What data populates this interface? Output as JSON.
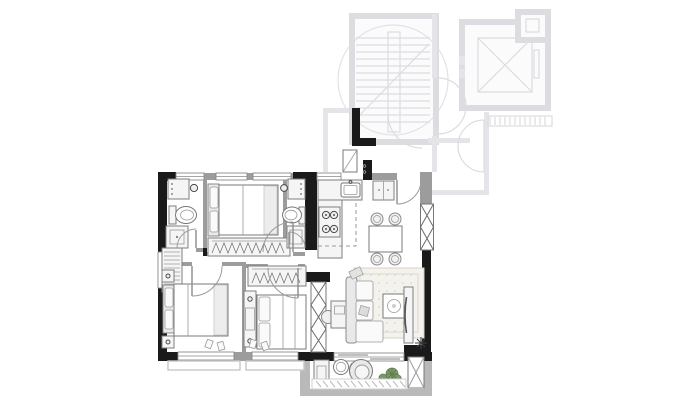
{
  "canvas": {
    "width": 694,
    "height": 411
  },
  "colors": {
    "background": "#ffffff",
    "wall_solid": "#1a1a1a",
    "wall_window": "#9c9c9c",
    "wall_light": "#b9b9b9",
    "fixture_stroke": "#7e7e7e",
    "fixture_dark": "#4a4a4a",
    "faded_common": "#dcdce1",
    "sill": "#c8c8c8",
    "rug_fill": "#f4f2ed",
    "rug_border": "#d8d3c9",
    "plant_green": "#7d9b68",
    "plant_dark": "#5e7c4e"
  },
  "plan": {
    "unit_rooms": [
      {
        "id": "bathroom-top-left",
        "fixtures": [
          "vanity-sink",
          "toilet",
          "shower"
        ]
      },
      {
        "id": "bedroom-top",
        "fixtures": [
          "double-bed",
          "wardrobe-with-hangers"
        ]
      },
      {
        "id": "bathroom-top-right",
        "fixtures": [
          "vanity-sink",
          "toilet",
          "shower"
        ]
      },
      {
        "id": "hallway",
        "fixtures": [
          "tall-shelf-cabinet"
        ]
      },
      {
        "id": "kitchen",
        "fixtures": [
          "l-counter",
          "cooktop-4-burner",
          "sink",
          "refrigerator"
        ]
      },
      {
        "id": "entry-nook",
        "fixtures": [
          "shoe-cabinet"
        ]
      },
      {
        "id": "dining",
        "fixtures": [
          "table",
          "chair",
          "chair",
          "chair",
          "chair"
        ]
      },
      {
        "id": "living",
        "fixtures": [
          "sofa",
          "rug",
          "coffee-table",
          "desk",
          "desk-chair",
          "tv-console",
          "plant"
        ]
      },
      {
        "id": "bedroom-bottom-left",
        "fixtures": [
          "double-bed",
          "nightstand",
          "nightstand",
          "slippers"
        ]
      },
      {
        "id": "bedroom-bottom-middle",
        "fixtures": [
          "double-bed",
          "wardrobe-with-hangers",
          "dresser",
          "slippers"
        ]
      },
      {
        "id": "balcony",
        "fixtures": [
          "storage-box",
          "round-table",
          "lounge-chair",
          "plants"
        ]
      }
    ],
    "structure": [
      "column-x-hatch",
      "column-x-hatch",
      "column-x-hatch",
      "window",
      "sliding-door",
      "bay-window-sill"
    ],
    "common_area": [
      "stairwell",
      "stair-treads",
      "elevator-shaft",
      "lobby-double-doors",
      "corridor",
      "neighbor-door",
      "vent-hatch-strip"
    ]
  }
}
